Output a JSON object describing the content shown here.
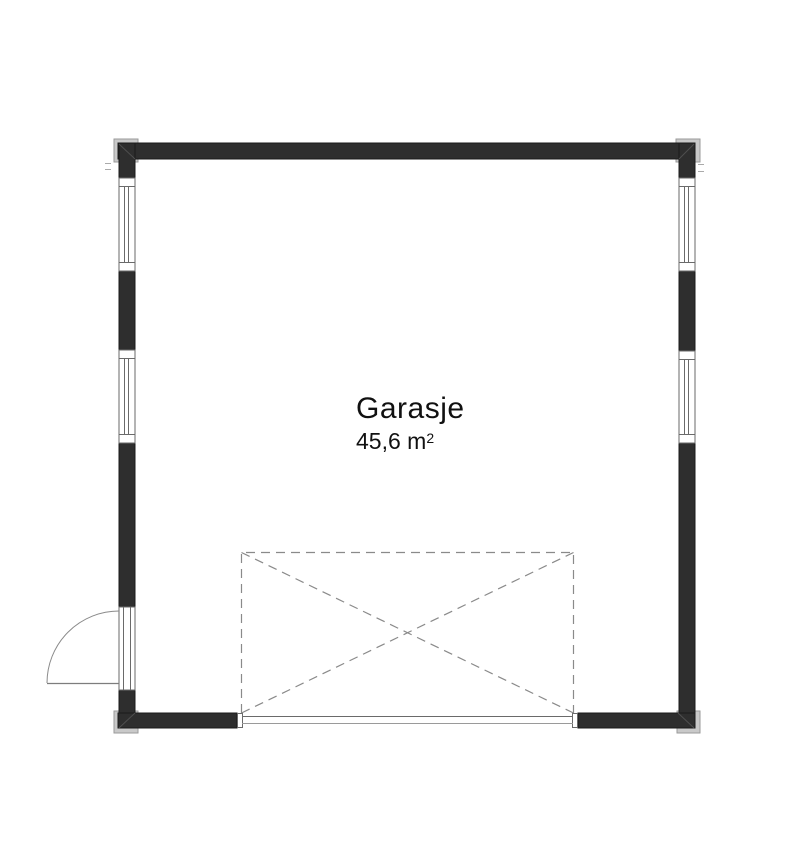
{
  "floorplan": {
    "room": {
      "name": "Garasje",
      "area_value": "45,6 m",
      "area_sup": "2"
    },
    "colors": {
      "background": "#ffffff",
      "wall": "#2e2e2e",
      "wall_outline": "#1b1b1b",
      "corner_cap": "#c9c9c9",
      "frame_line": "#6a6a6a",
      "threshold_line": "#9a9a9a",
      "door_line": "#7d7d7d",
      "swing_arc": "#8a8a8a",
      "dashed_line": "#8a8a8a",
      "text": "#111111"
    },
    "symbols": {
      "window": "double-pane-window-symbol",
      "entry_door": "quarter-circle-swing-arc",
      "garage_door": "dashed-rect-with-x-opening"
    }
  }
}
